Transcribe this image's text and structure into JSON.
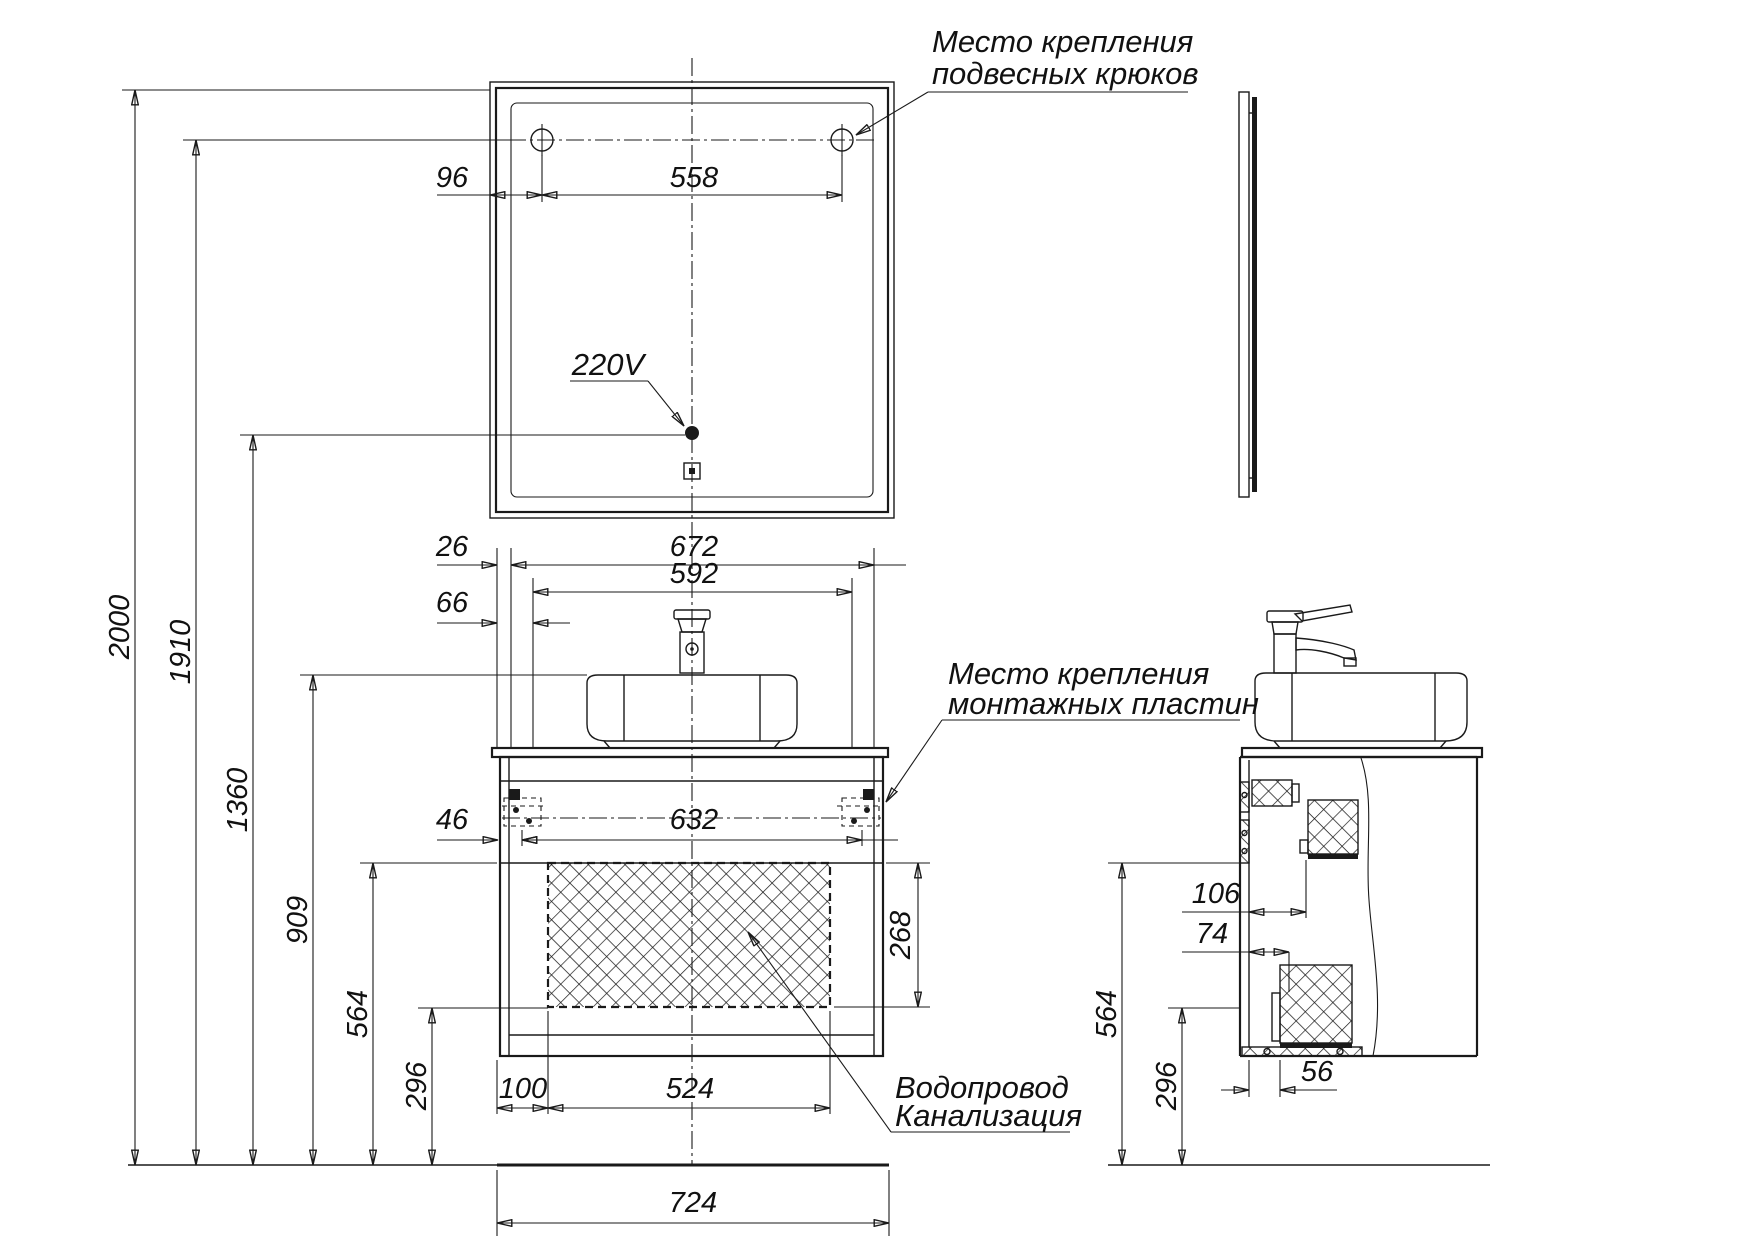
{
  "drawing": {
    "labels": {
      "hooks": {
        "line1": "Место крепления",
        "line2": "подвесных крюков"
      },
      "power": "220V",
      "plates": {
        "line1": "Место крепления",
        "line2": "монтажных пластин"
      },
      "plumbing": {
        "line1": "Водопровод",
        "line2": "Канализация"
      }
    },
    "dims": {
      "mirror_offset": "96",
      "hooks_span": "558",
      "h_total": "2000",
      "h_hooks": "1910",
      "h_outlet": "1360",
      "h_basin": "909",
      "h_zone_top": "564",
      "h_zone_bottom": "296",
      "top_inset": "26",
      "inner_width": "672",
      "mount_span": "592",
      "edge_offset": "66",
      "plate_edge": "46",
      "plate_span": "632",
      "hatch_offset": "100",
      "hatch_width": "524",
      "hatch_height": "268",
      "width_total": "724",
      "side_rail": "106",
      "side_bracket": "74",
      "side_zone_top": "564",
      "side_zone_bottom": "296",
      "side_drain": "56"
    },
    "line_color": "#1a1a1a"
  }
}
